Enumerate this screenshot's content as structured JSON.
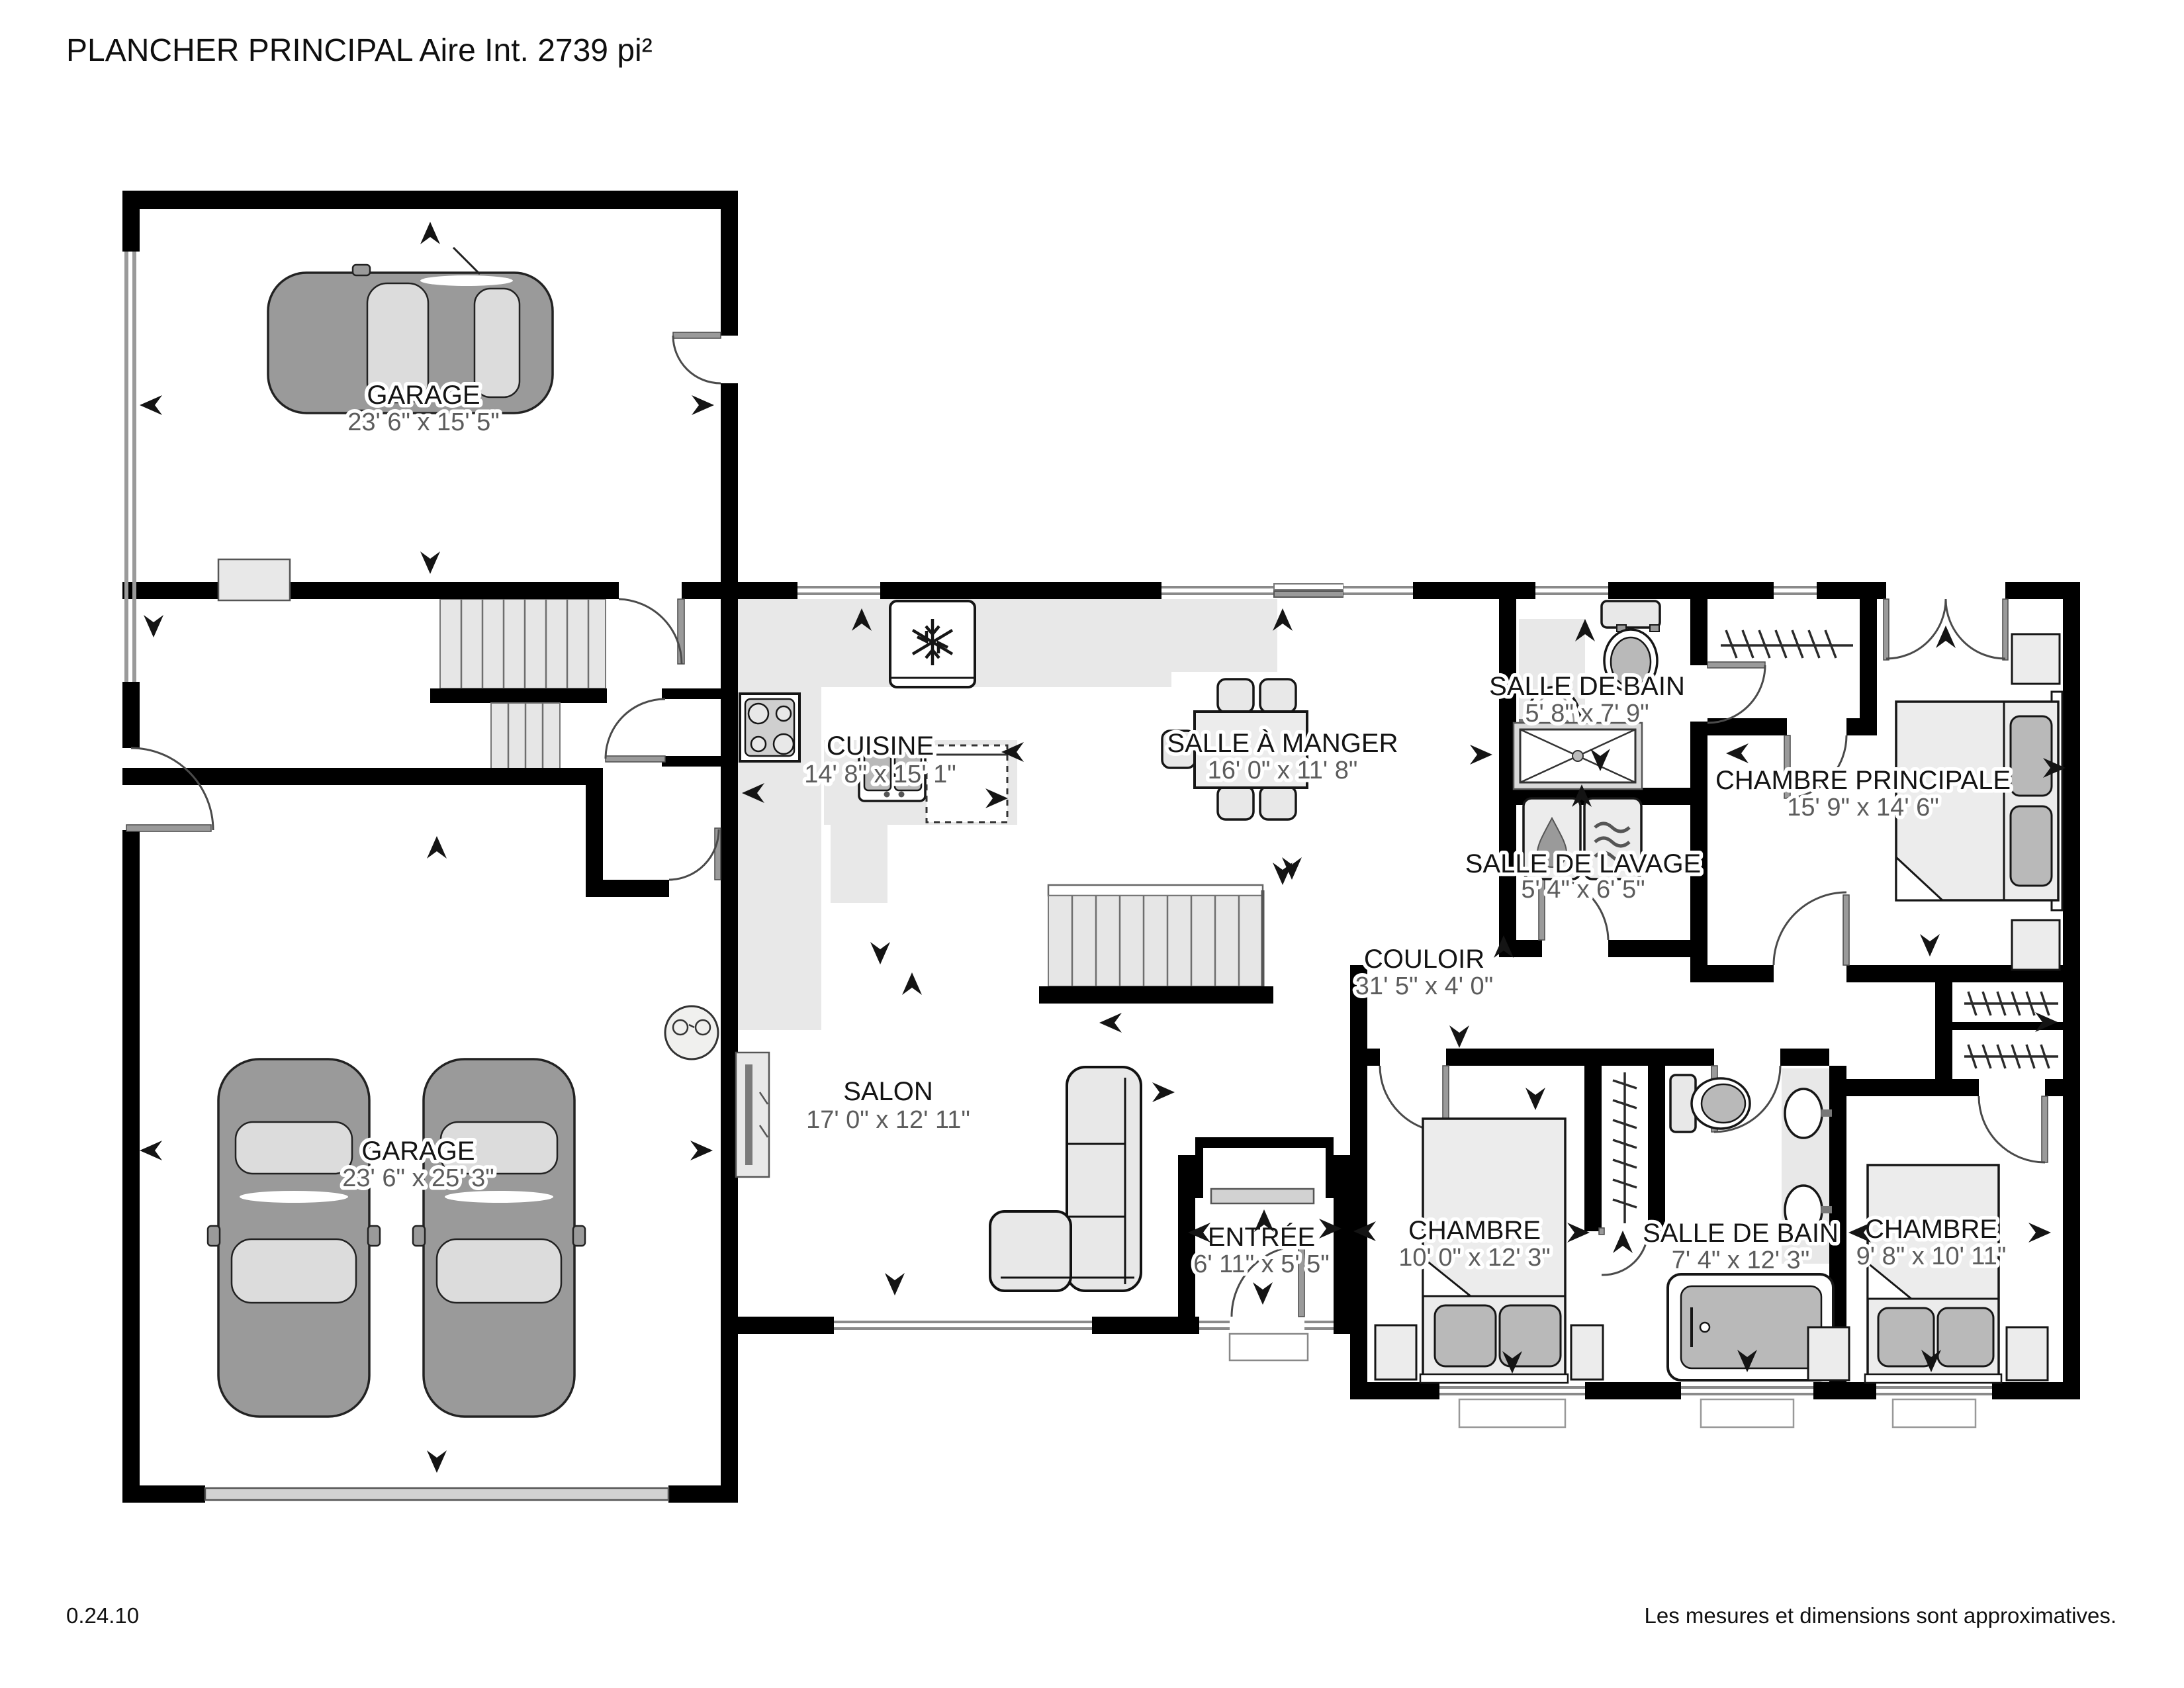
{
  "title": "PLANCHER PRINCIPAL Aire Int. 2739 pi²",
  "footer": {
    "version": "0.24.10",
    "disclaimer": "Les mesures et dimensions sont approximatives."
  },
  "rooms": {
    "garage_top": {
      "label": "GARAGE",
      "dims": "23' 6\" x 15' 5\""
    },
    "garage_main": {
      "label": "GARAGE",
      "dims": "23' 6\" x 25' 3\""
    },
    "cuisine": {
      "label": "CUISINE",
      "dims": "14' 8\" x 15' 1\""
    },
    "salle_a_manger": {
      "label": "SALLE À MANGER",
      "dims": "16' 0\" x 11' 8\""
    },
    "salle_de_bain_1": {
      "label": "SALLE DE BAIN",
      "dims": "5' 8\" x 7' 9\""
    },
    "salle_de_lavage": {
      "label": "SALLE DE LAVAGE",
      "dims": "5' 4\" x 6' 5\""
    },
    "chambre_principale": {
      "label": "CHAMBRE PRINCIPALE",
      "dims": "15' 9\" x 14' 6\""
    },
    "couloir": {
      "label": "COULOIR",
      "dims": "31' 5\" x 4' 0\""
    },
    "salon": {
      "label": "SALON",
      "dims": "17' 0\" x 12' 11\""
    },
    "entree": {
      "label": "ENTRÉE",
      "dims": "6' 11\" x 5' 5\""
    },
    "chambre_1": {
      "label": "CHAMBRE",
      "dims": "10' 0\" x 12' 3\""
    },
    "salle_de_bain_2": {
      "label": "SALLE DE BAIN",
      "dims": "7' 4\" x 12' 3\""
    },
    "chambre_2": {
      "label": "CHAMBRE",
      "dims": "9' 8\" x 10' 11\""
    }
  },
  "colors": {
    "wall": "#000000",
    "floor": "#ffffff",
    "furniture_light": "#e8e8e8",
    "furniture_mid": "#b9b9b9",
    "car_body": "#9a9a9a",
    "label_text": "#141414",
    "dim_text": "#5c5c5c"
  }
}
